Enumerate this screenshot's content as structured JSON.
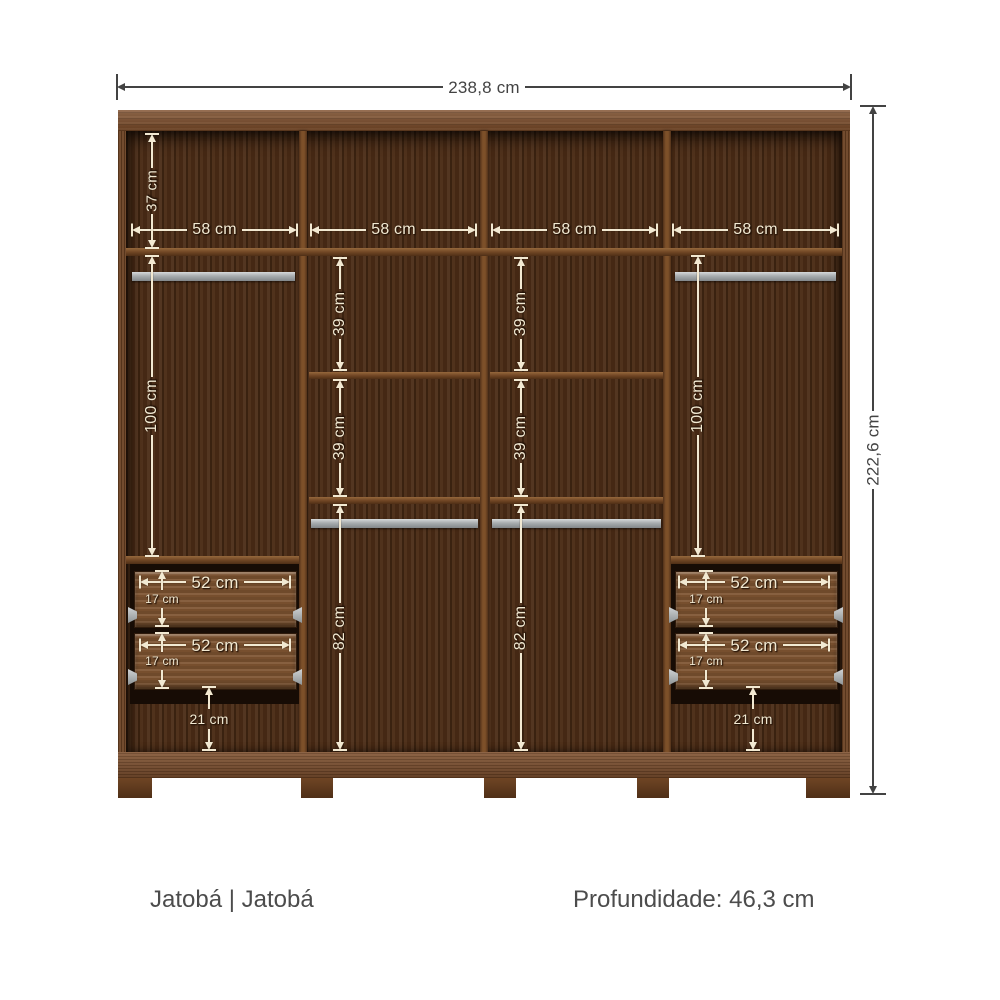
{
  "dims": {
    "overall_width": "238,8 cm",
    "overall_height": "222,6 cm",
    "top_section": "37 cm",
    "section_width": "58 cm",
    "hanging": "100 cm",
    "shelf_gap": "39 cm",
    "lower_section": "82 cm",
    "drawer_width": "52 cm",
    "drawer_height": "17 cm",
    "below_drawers": "21 cm"
  },
  "footer": {
    "finish_label": "Jatobá | Jatobá",
    "depth_label": "Profundidade: 46,3 cm"
  },
  "colors": {
    "wood_light": "#7c4b27",
    "wood_dark_interior": "#4a2b15",
    "rod_silver": "#a7acae",
    "annotation_light": "#f2e9d2",
    "annotation_dark": "#434343",
    "footer_text": "#4c4c4c",
    "background": "#ffffff"
  }
}
